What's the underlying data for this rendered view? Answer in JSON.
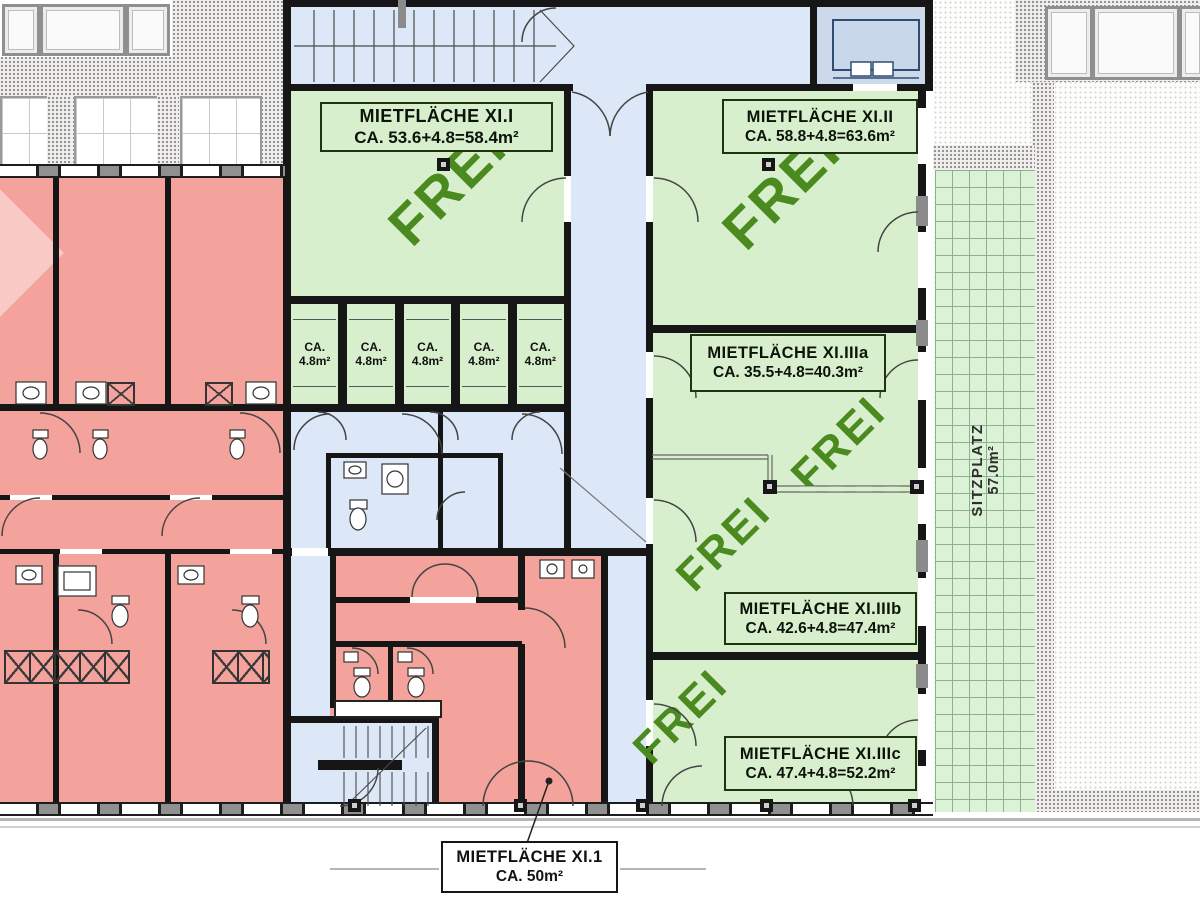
{
  "watermark": {
    "text": "FREI"
  },
  "rooms": {
    "xi_i": {
      "name": "MIETFLÄCHE XI.I",
      "area": "CA. 53.6+4.8=58.4m²"
    },
    "xi_ii": {
      "name": "MIETFLÄCHE XI.II",
      "area": "CA. 58.8+4.8=63.6m²"
    },
    "xi_iiia": {
      "name": "MIETFLÄCHE XI.IIIa",
      "area": "CA. 35.5+4.8=40.3m²"
    },
    "xi_iiib": {
      "name": "MIETFLÄCHE XI.IIIb",
      "area": "CA. 42.6+4.8=47.4m²"
    },
    "xi_iiic": {
      "name": "MIETFLÄCHE XI.IIIc",
      "area": "CA. 47.4+4.8=52.2m²"
    },
    "xi_1": {
      "name": "MIETFLÄCHE XI.1",
      "area": "CA. 50m²"
    }
  },
  "cells": {
    "line1": "CA.",
    "line2": "4.8m²"
  },
  "terrace": {
    "name": "SITZPLATZ",
    "area": "57.0m²"
  },
  "colors": {
    "free_room": "#d8efce",
    "frei_text": "#4a8a1f",
    "rented": "#f3a29c",
    "common_area": "#dce8f7",
    "wall": "#161616",
    "terrace_tiles": "#dcf2d6"
  }
}
